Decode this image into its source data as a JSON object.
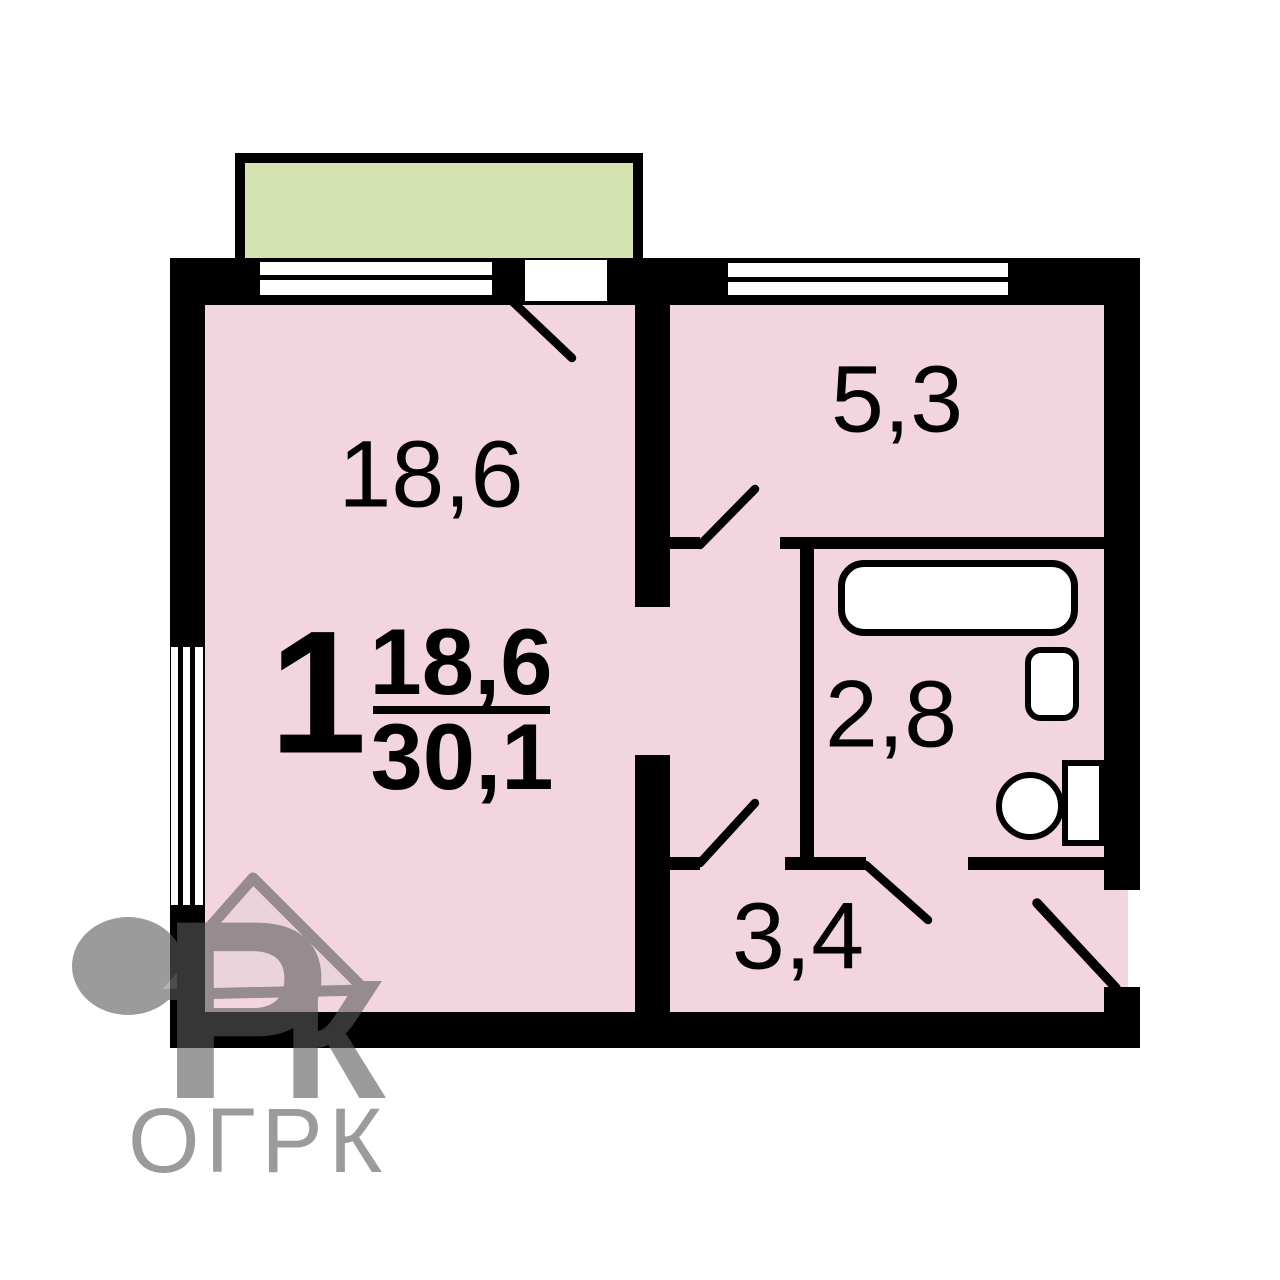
{
  "floor_plan": {
    "apartment": {
      "number": "1",
      "living_area": "18,6",
      "total_area": "30,1"
    },
    "rooms": [
      {
        "name": "living-room",
        "area": "18,6"
      },
      {
        "name": "kitchen",
        "area": "5,3"
      },
      {
        "name": "bathroom",
        "area": "2,8"
      },
      {
        "name": "hallway",
        "area": "3,4"
      }
    ],
    "fixtures": [
      "bathtub",
      "sink",
      "toilet"
    ],
    "features": [
      "balcony",
      "windows",
      "door-swings",
      "entrance-door"
    ],
    "colors": {
      "room_fill": "#f3d5df",
      "balcony_fill": "#d4e3b0",
      "walls": "#000000",
      "background": "#ffffff",
      "watermark": "#5a5a5a"
    }
  },
  "watermark": {
    "logo_letter_p": "Р",
    "logo_letter_k": "К",
    "agency_name": "ОГРК"
  }
}
